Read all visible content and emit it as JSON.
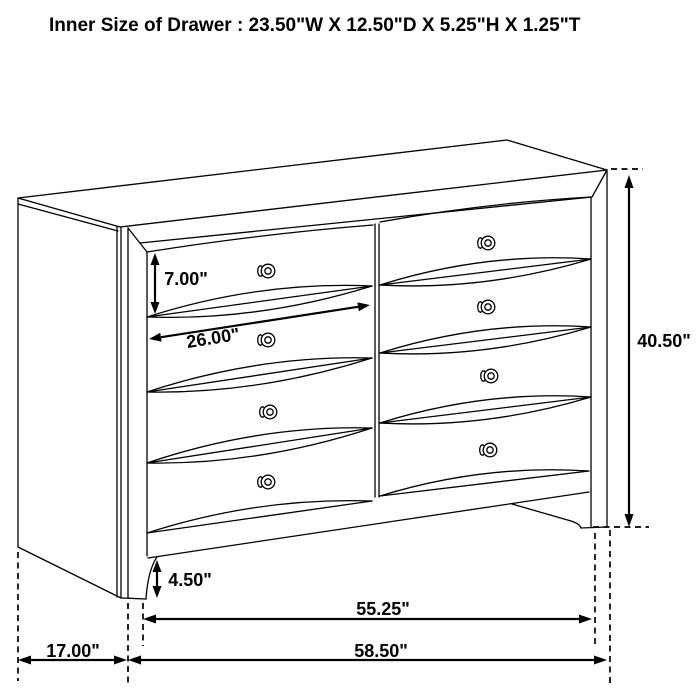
{
  "page": {
    "background": "#ffffff",
    "line_color": "#000000"
  },
  "title": "Inner Size of Drawer : 23.50\"W X 12.50\"D X 5.25\"H X 1.25\"T",
  "dimensions": {
    "drawer_front_height": "7.00\"",
    "drawer_front_width": "26.00\"",
    "overall_height": "40.50\"",
    "base_height": "4.50\"",
    "leg_span_width": "55.25\"",
    "overall_width": "58.50\"",
    "side_depth": "17.00\""
  }
}
